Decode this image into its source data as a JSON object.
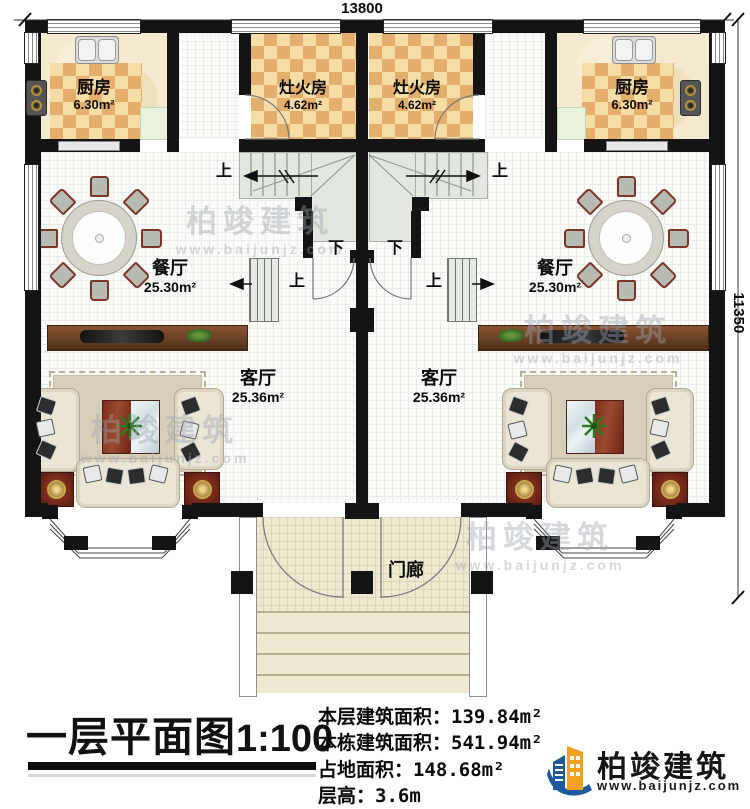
{
  "dimensions": {
    "top": "13800",
    "right": "11350"
  },
  "rooms": {
    "kitchen": {
      "name": "厨房",
      "area": "6.30m²"
    },
    "stove_room": {
      "name": "灶火房",
      "area": "4.62m²"
    },
    "dining": {
      "name": "餐厅",
      "area": "25.30m²"
    },
    "living": {
      "name": "客厅",
      "area": "25.36m²"
    },
    "porch": {
      "name": "门廊"
    }
  },
  "stairs": {
    "up": "上",
    "down": "下"
  },
  "title_block": {
    "title": "一层平面图",
    "scale": "1:100",
    "info": [
      {
        "label": "本层建筑面积：",
        "value": "139.84m²"
      },
      {
        "label": "本栋建筑面积：",
        "value": "541.94m²"
      },
      {
        "label": "占地面积：",
        "value": "148.68m²"
      },
      {
        "label": "层高：",
        "value": "3.6m"
      }
    ]
  },
  "logo": {
    "name": "柏竣建筑",
    "url": "www.baijunjz.com"
  },
  "watermark": {
    "text": "柏竣建筑",
    "url": "www.baijunjz.com"
  },
  "colors": {
    "wall": "#141414",
    "checker_dark": "#e4ae6c",
    "checker_light": "#f6dda6",
    "logo_blue": "#1d5a9e",
    "logo_orange": "#f2a01e"
  }
}
